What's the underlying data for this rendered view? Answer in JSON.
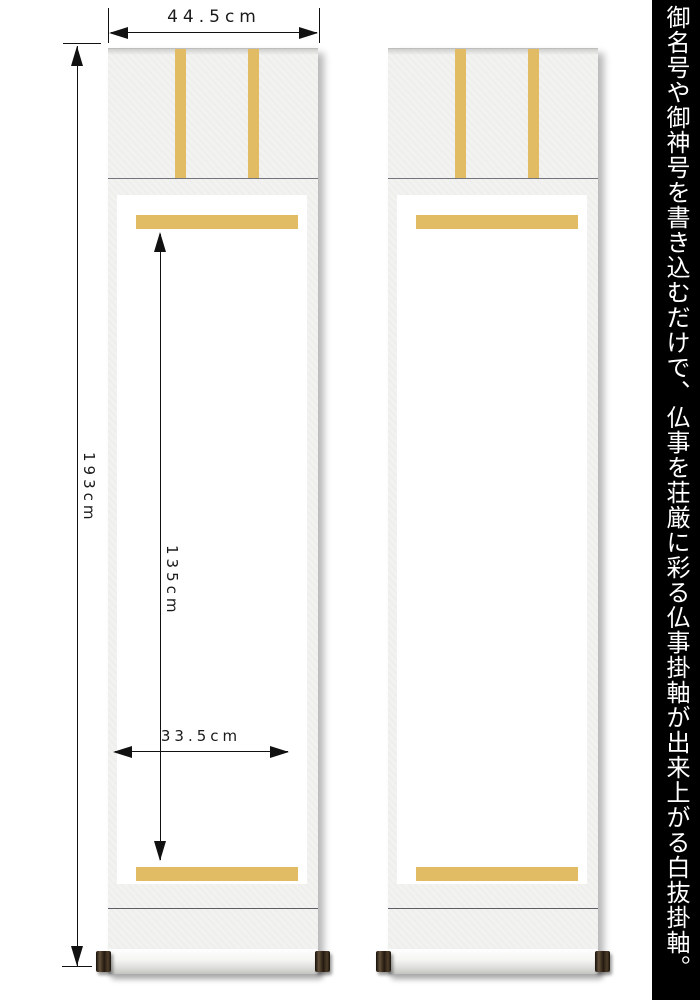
{
  "caption": {
    "text": "御名号や御神号を書き込むだけで、仏事を荘厳に彩る仏事掛軸が出来上がる白抜掛軸。",
    "background": "#000000",
    "color": "#ffffff"
  },
  "dimensions": {
    "total_width": "44.5cm",
    "total_height": "193cm",
    "inner_height": "135cm",
    "inner_width": "33.5cm"
  },
  "scrolls": {
    "count": 2,
    "description_parts": [
      "futai-ribbons",
      "ichimonji-gold-strips",
      "white-honshi-area",
      "roller-with-dark-knobs"
    ]
  },
  "colors": {
    "gold_strip": "#e1bc64",
    "mount_cloth": "#f2f2f0",
    "honshi_paper": "#ffffff",
    "dimension_lines": "#111111",
    "caption_background": "#000000",
    "caption_text": "#ffffff",
    "roller_knob": "#3a2d1c"
  }
}
